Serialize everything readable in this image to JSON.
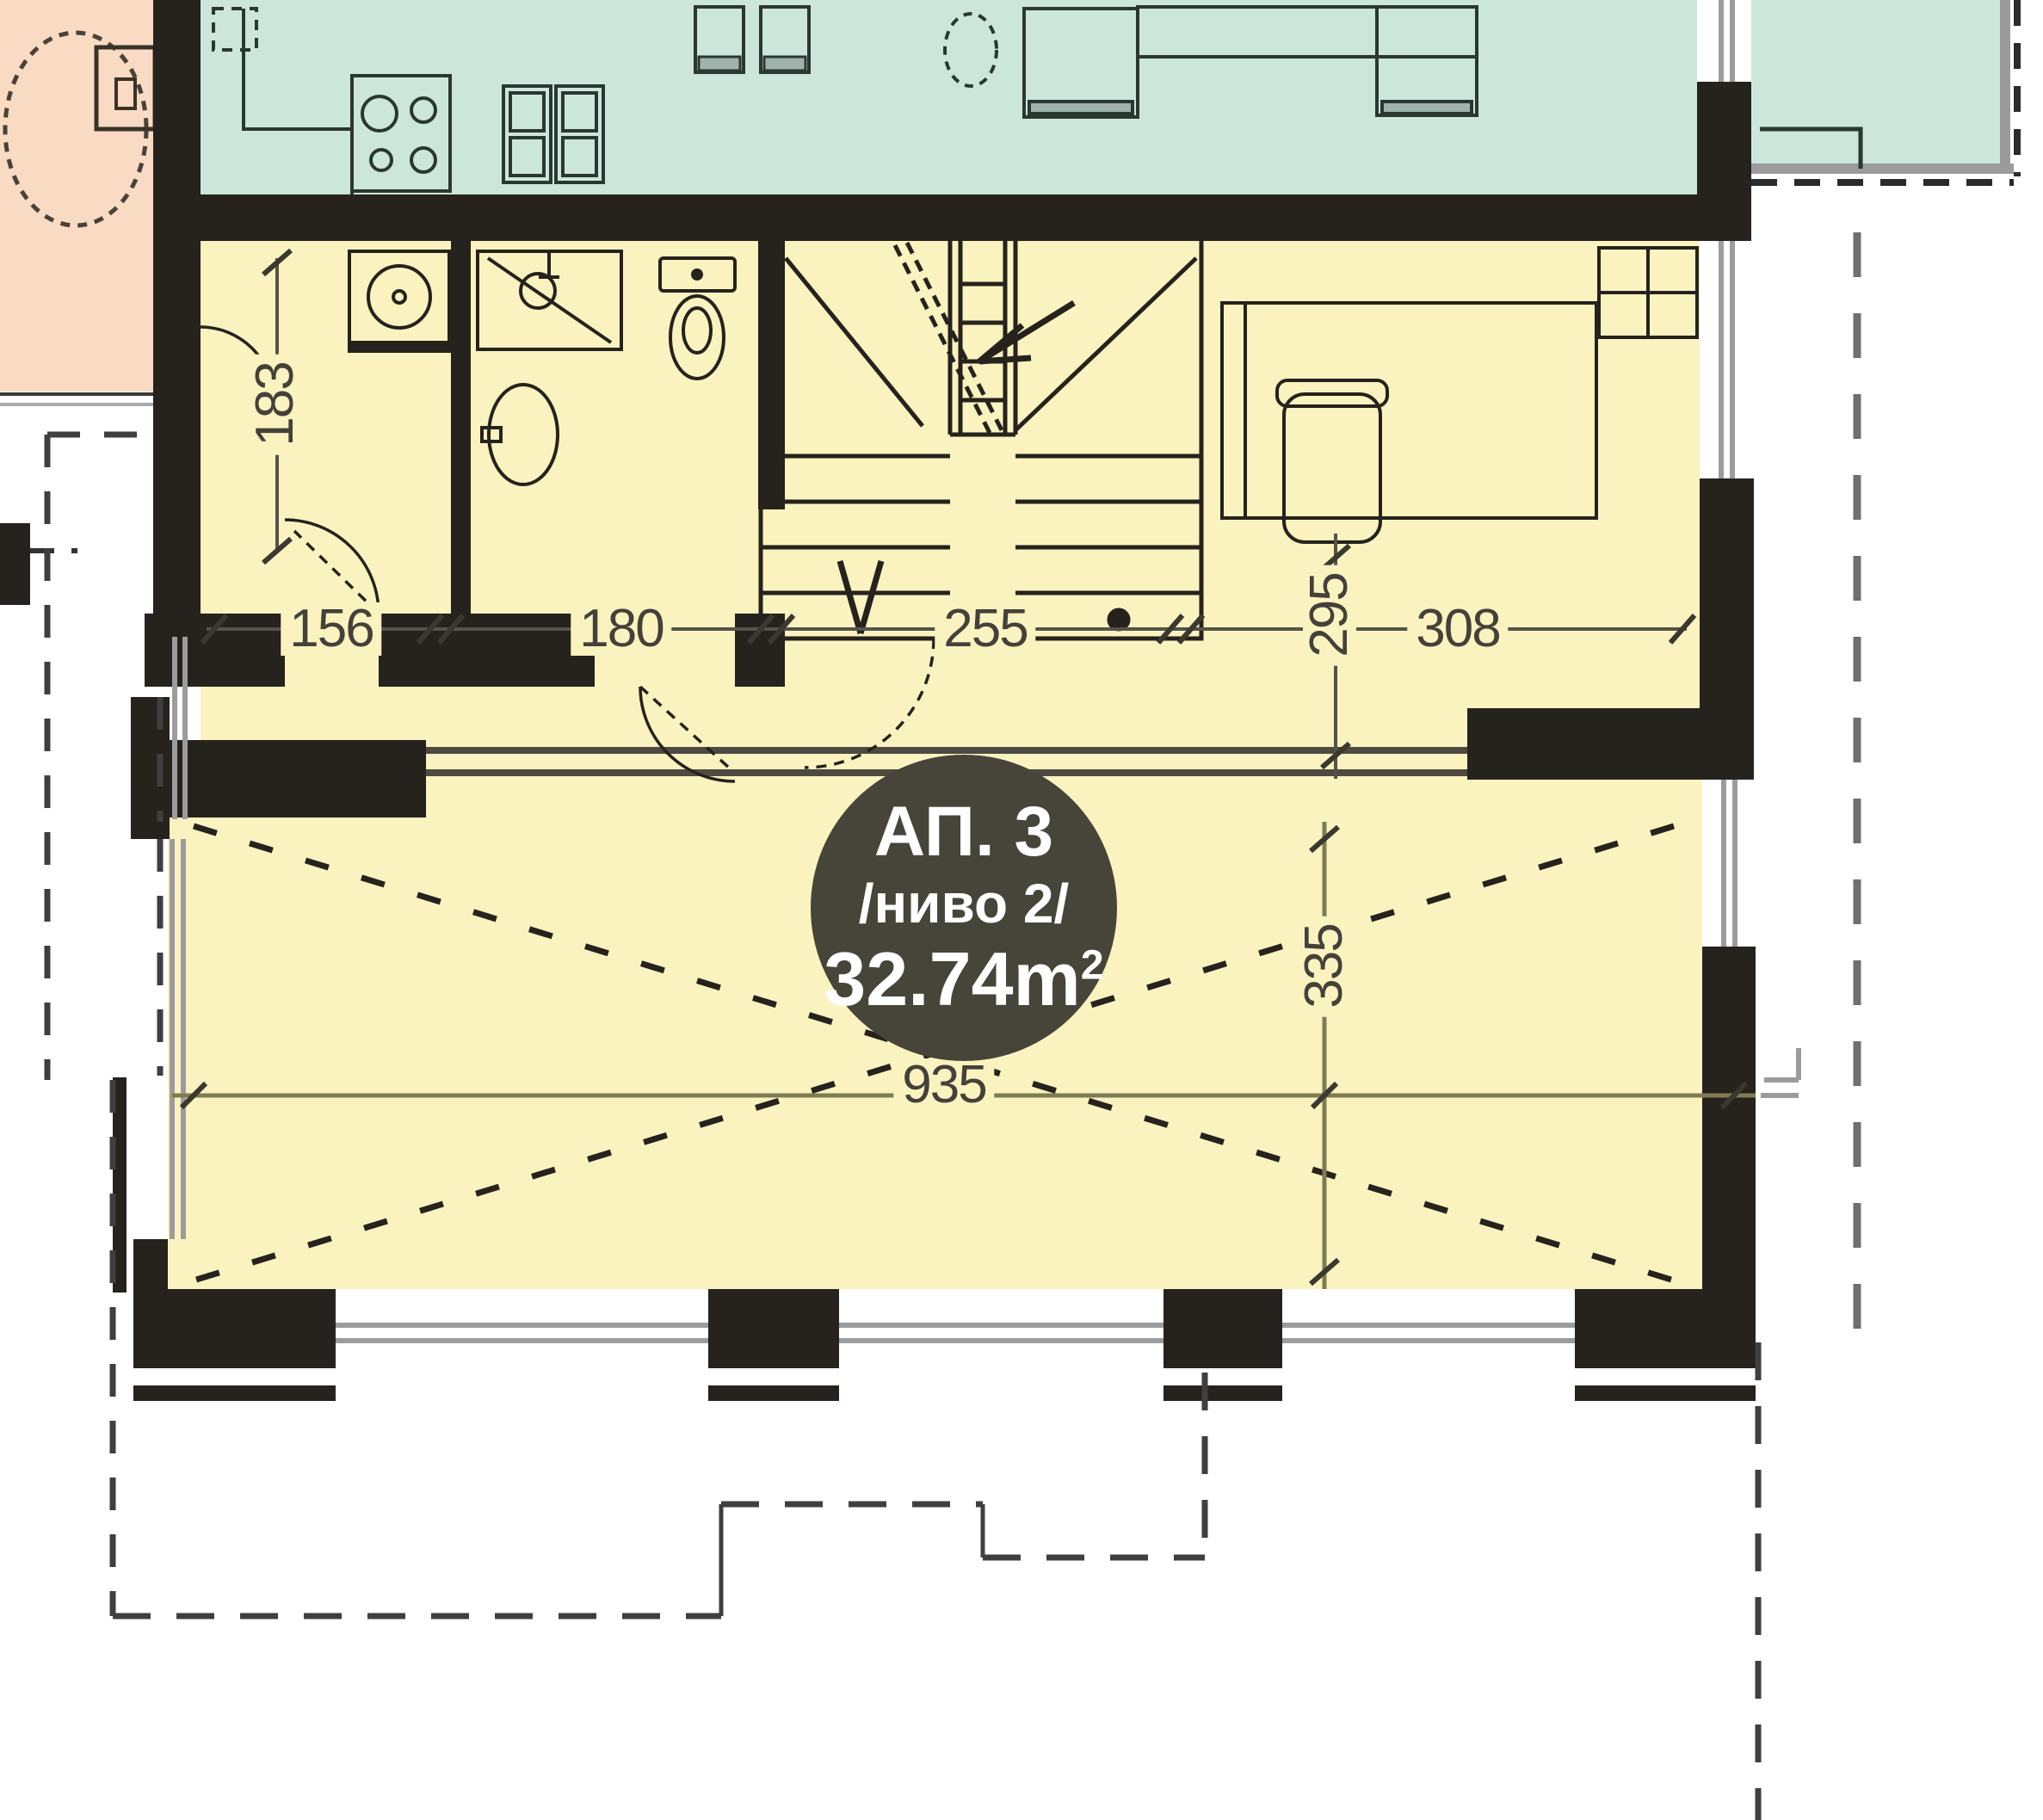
{
  "plan": {
    "unit_badge": {
      "line1": "АП. 3",
      "line2": "/ниво 2/",
      "area": "32.74m",
      "area_sup": "2"
    },
    "dimensions": {
      "laundry_height": "183",
      "hall_width": "156",
      "bath_width": "180",
      "stairs_width": "255",
      "room_depth": "295",
      "desk_room_width": "308",
      "living_depth": "335",
      "living_width": "935"
    },
    "colors": {
      "apartment_fill": "#faf3bf",
      "neighbor_fill": "#cde6dc",
      "corridor_fill": "#f8dbc2",
      "wall": "#26221d",
      "window_line": "#9c9c9c",
      "dimension_line": "#7f7c52",
      "dimension_text": "#44403a",
      "badge_fill": "#474439",
      "badge_text": "#ffffff"
    }
  }
}
